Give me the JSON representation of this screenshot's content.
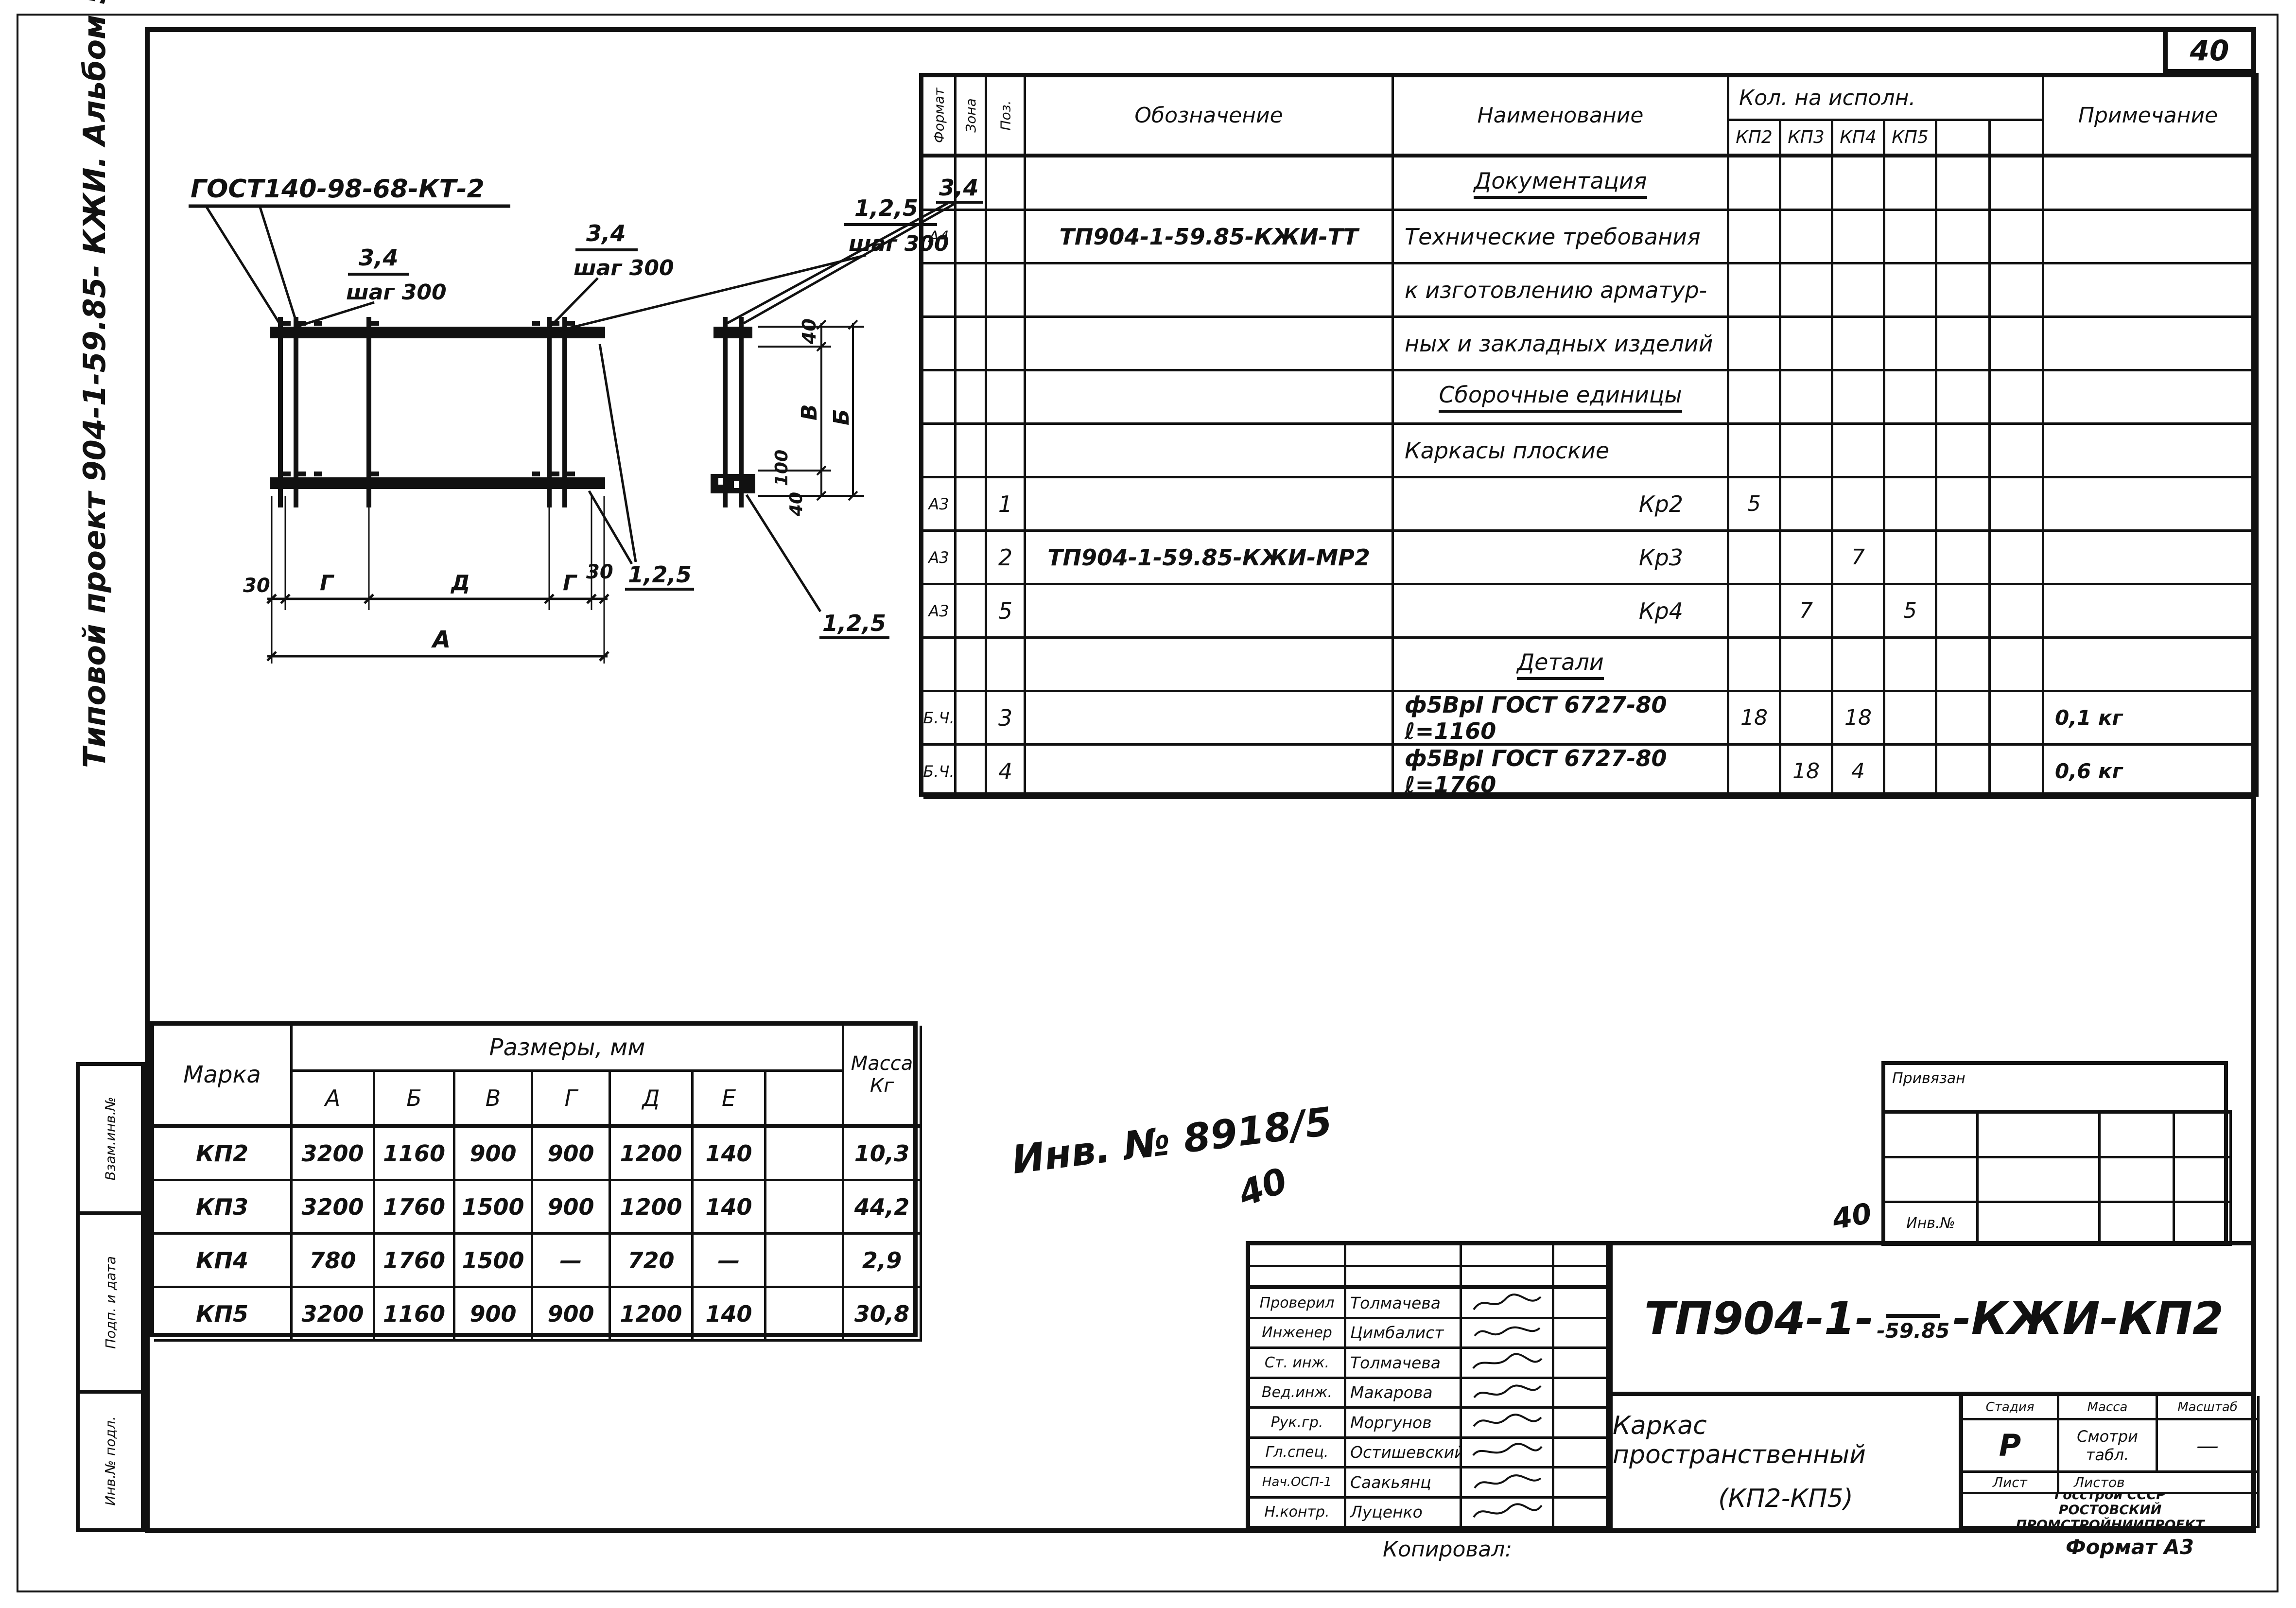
{
  "page": {
    "number": "40",
    "sidebar_text": "Типовой проект 904-1-59.85- КЖИ. Альбом 5",
    "copied_label": "Копировал:",
    "format_label": "Формат А3",
    "inv_handwritten": "Инв. № 8918/5",
    "inv_handwritten_extra": "40"
  },
  "left_strip": {
    "cells": [
      "Взам.инв.№",
      "Подп. и дата",
      "Инв.№ подл."
    ]
  },
  "drawing": {
    "gost_label": "ГОСТ140-98-68-КТ-2",
    "frac34": "3,4",
    "step300": "шаг 300",
    "set125": "1,2,5",
    "dim30": "30",
    "dimG": "Г",
    "dimD": "Д",
    "dimA": "А",
    "dim40": "40",
    "dim100": "100",
    "dimV": "В",
    "dimB": "Б"
  },
  "spec_table": {
    "header": {
      "format": "Формат",
      "zone": "Зона",
      "pos": "Поз.",
      "designation": "Обозначение",
      "name": "Наименование",
      "qty": "Кол. на исполн.",
      "kp2": "КП2",
      "kp3": "КП3",
      "kp4": "КП4",
      "kp5": "КП5",
      "note": "Примечание"
    },
    "rows": [
      {
        "name": "Документация"
      },
      {
        "fmt": "А4",
        "ref": "ТП904-1-59.85-КЖИ-ТТ",
        "name": "Технические требования"
      },
      {
        "name": "к изготовлению арматур-"
      },
      {
        "name": "ных и закладных изделий"
      },
      {
        "name": "Сборочные единицы"
      },
      {
        "name": "Каркасы плоские"
      },
      {
        "fmt": "А3",
        "pos": "1",
        "name": "Кр2",
        "kp2": "5"
      },
      {
        "fmt": "А3",
        "pos": "2",
        "ref": "ТП904-1-59.85-КЖИ-МР2",
        "name": "Кр3",
        "kp4": "7"
      },
      {
        "fmt": "А3",
        "pos": "5",
        "name": "Кр4",
        "kp3": "7",
        "kp5": "5"
      },
      {
        "name": "Детали"
      },
      {
        "fmt": "Б.Ч.",
        "pos": "3",
        "name": "ф5ВрI ГОСТ 6727-80 ℓ=1160",
        "kp2": "18",
        "kp4": "18",
        "note": "0,1 кг"
      },
      {
        "fmt": "Б.Ч.",
        "pos": "4",
        "name": "ф5ВрI ГОСТ 6727-80 ℓ=1760",
        "kp3": "18",
        "kp4": "4",
        "note": "0,6 кг"
      }
    ]
  },
  "size_table": {
    "col_mark": "Марка",
    "col_sizes": "Размеры, мм",
    "col_mass_line1": "Масса",
    "col_mass_line2": "Кг",
    "dims": [
      "А",
      "Б",
      "В",
      "Г",
      "Д",
      "Е"
    ],
    "rows": [
      {
        "mark": "КП2",
        "a": "3200",
        "b": "1160",
        "v": "900",
        "g": "900",
        "d": "1200",
        "e": "140",
        "mass": "10,3"
      },
      {
        "mark": "КП3",
        "a": "3200",
        "b": "1760",
        "v": "1500",
        "g": "900",
        "d": "1200",
        "e": "140",
        "mass": "44,2"
      },
      {
        "mark": "КП4",
        "a": "780",
        "b": "1760",
        "v": "1500",
        "g": "—",
        "d": "720",
        "e": "—",
        "mass": "2,9"
      },
      {
        "mark": "КП5",
        "a": "3200",
        "b": "1160",
        "v": "900",
        "g": "900",
        "d": "1200",
        "e": "140",
        "mass": "30,8"
      }
    ]
  },
  "pinned_table": {
    "title": "Привязан",
    "inv_label": "Инв.№",
    "handwritten": "40"
  },
  "stamp": {
    "doc_prefix": "ТП904-1-",
    "doc_sub": "-59.85",
    "doc_suffix": "-КЖИ-КП2",
    "title_line1": "Каркас пространственный",
    "title_line2": "(КП2-КП5)",
    "stage_label": "Стадия",
    "mass_label": "Масса",
    "scale_label": "Масштаб",
    "stage_value": "Р",
    "mass_value_line1": "Смотри",
    "mass_value_line2": "табл.",
    "scale_value": "—",
    "sheet_label": "Лист",
    "sheets_label": "Листов",
    "org_line1": "Госстрой СССР",
    "org_line2": "РОСТОВСКИЙ",
    "org_line3": "ПРОМСТРОЙНИИПРОЕКТ",
    "signers": [
      {
        "role": "Проверил",
        "name": "Толмачева"
      },
      {
        "role": "Инженер",
        "name": "Цимбалист"
      },
      {
        "role": "Ст. инж.",
        "name": "Толмачева"
      },
      {
        "role": "Вед.инж.",
        "name": "Макарова"
      },
      {
        "role": "Рук.гр.",
        "name": "Моргунов"
      },
      {
        "role": "Гл.спец.",
        "name": "Остишевский"
      },
      {
        "role": "Нач.ОСП-1",
        "name": "Саакьянц"
      },
      {
        "role": "Н.контр.",
        "name": "Луценко"
      }
    ]
  }
}
